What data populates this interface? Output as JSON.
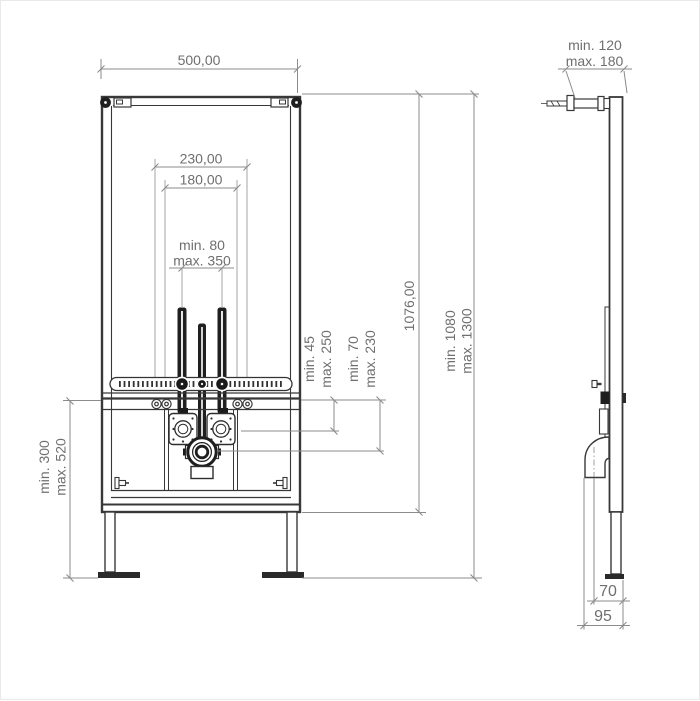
{
  "drawing_type": "installation-frame-technical-drawing",
  "colors": {
    "frame_line": "#383838",
    "solid_fill": "#1f1f1f",
    "dimension_line": "#8b8b8b",
    "dimension_text": "#6f6f6f",
    "background": "#ffffff"
  },
  "front": {
    "overall_width": "500,00",
    "rail_width": "230,00",
    "rail_inner_width": "180,00",
    "fixing_spacing_min": "min. 80",
    "fixing_spacing_max": "max. 350",
    "frame_height": "1076,00",
    "install_height_min": "min. 1080",
    "install_height_max": "max. 1300",
    "upper_offset_min": "min. 45",
    "upper_offset_max": "max. 250",
    "lower_offset_min": "min. 70",
    "lower_offset_max": "max. 230",
    "drain_height_min": "min. 300",
    "drain_height_max": "max. 520"
  },
  "side": {
    "rod_length_min": "min. 120",
    "rod_length_max": "max. 180",
    "depth_to_pipe": "70",
    "depth_total": "95"
  }
}
